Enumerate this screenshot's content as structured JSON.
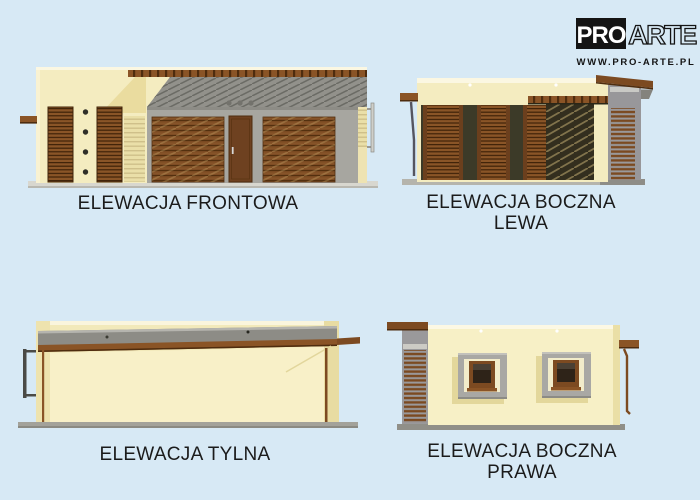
{
  "logo": {
    "pro": "PRO",
    "arte": "ARTE",
    "url": "WWW.PRO-ARTE.PL"
  },
  "elevations": {
    "front": {
      "label": "ELEWACJA FRONTOWA"
    },
    "left": {
      "label_line1": "ELEWACJA BOCZNA",
      "label_line2": "LEWA"
    },
    "rear": {
      "label": "ELEWACJA TYLNA"
    },
    "right": {
      "label_line1": "ELEWACJA BOCZNA",
      "label_line2": "PRAWA"
    }
  },
  "colors": {
    "background": "#d7e9f5",
    "wall-cream": "#f4ecc0",
    "wall-cream-shade": "#eadc9f",
    "facade-gray": "#a7a6a0",
    "pergola-gray": "#92918b",
    "strip-gray": "#9a999b",
    "base-gray": "#b5b4ac",
    "wood-brown": "#8a5426",
    "wood-dark": "#4e2c0e",
    "door-brown": "#6e4120",
    "glass-dark": "#2e2318",
    "opening-dark": "#332e1e",
    "label-text": "#1b1b1b",
    "logo-black": "#141414"
  }
}
